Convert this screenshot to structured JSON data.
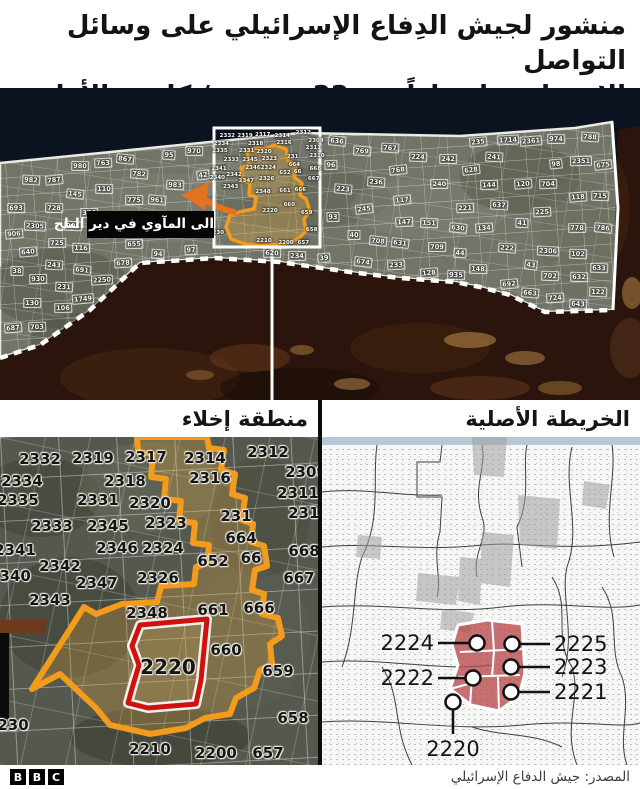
{
  "header": {
    "line1": "منشور لجيش الدِفاع الإسرائيلي على وسائل التواصل",
    "line2": "الاجتماعي اعتباراً من 22 ديسمبر/ كانون الأول"
  },
  "main_map": {
    "evacuation_label": "الى المآوي في دير البلح",
    "zone_numbers": [
      "93",
      "94",
      "95",
      "96",
      "97",
      "98",
      "110",
      "102",
      "106",
      "122",
      "118",
      "117",
      "116",
      "43",
      "44",
      "41",
      "42",
      "38",
      "39",
      "40",
      "36",
      "221",
      "222",
      "223",
      "224",
      "225",
      "231",
      "233",
      "234",
      "235",
      "236",
      "240",
      "241",
      "242",
      "243",
      "245",
      "140",
      "151",
      "134",
      "148",
      "128",
      "130",
      "120",
      "145",
      "144",
      "147",
      "2305",
      "2306",
      "2351",
      "2250",
      "2361",
      "676",
      "678",
      "787",
      "788",
      "786",
      "663",
      "708",
      "782",
      "983",
      "980",
      "769",
      "778",
      "728",
      "785",
      "709",
      "775",
      "725",
      "724",
      "741",
      "767",
      "763",
      "768",
      "982",
      "974",
      "970",
      "632",
      "687",
      "704",
      "703",
      "702",
      "693",
      "692",
      "674",
      "643",
      "633",
      "637",
      "675",
      "635",
      "640",
      "628",
      "630",
      "631",
      "603",
      "691",
      "715",
      "796",
      "963",
      "961",
      "910",
      "905",
      "902",
      "906",
      "900",
      "620",
      "608",
      "1101",
      "1743",
      "1745",
      "1744",
      "1746",
      "1747",
      "1750",
      "1749",
      "1785",
      "1756",
      "645",
      "634",
      "638",
      "672",
      "646",
      "636",
      "655",
      "934",
      "653",
      "722",
      "723",
      "733",
      "734",
      "753",
      "751",
      "755",
      "758",
      "756",
      "525",
      "527",
      "572",
      "573",
      "578",
      "576",
      "523",
      "378",
      "374",
      "376",
      "852",
      "864",
      "867",
      "745",
      "731",
      "817",
      "717",
      "811",
      "577",
      "528",
      "571",
      "575",
      "579",
      "581",
      "587",
      "590",
      "930",
      "927",
      "981",
      "935",
      "882",
      "861",
      "685",
      "341",
      "310",
      "1722",
      "1714",
      "854"
    ]
  },
  "left_panel": {
    "title": "منطقة إخلاء",
    "highlighted_zone": "2220",
    "labels": [
      {
        "n": "2332",
        "x": 40,
        "y": 22
      },
      {
        "n": "2319",
        "x": 93,
        "y": 21
      },
      {
        "n": "2317",
        "x": 146,
        "y": 20
      },
      {
        "n": "2314",
        "x": 205,
        "y": 21
      },
      {
        "n": "2312",
        "x": 268,
        "y": 15
      },
      {
        "n": "2334",
        "x": 22,
        "y": 44
      },
      {
        "n": "2318",
        "x": 125,
        "y": 44
      },
      {
        "n": "2316",
        "x": 210,
        "y": 41
      },
      {
        "n": "2309",
        "x": 306,
        "y": 35
      },
      {
        "n": "2335",
        "x": 18,
        "y": 63
      },
      {
        "n": "2331",
        "x": 98,
        "y": 63
      },
      {
        "n": "2320",
        "x": 150,
        "y": 66
      },
      {
        "n": "2311",
        "x": 298,
        "y": 56
      },
      {
        "n": "231",
        "x": 236,
        "y": 79
      },
      {
        "n": "2310",
        "x": 309,
        "y": 76
      },
      {
        "n": "2333",
        "x": 52,
        "y": 89
      },
      {
        "n": "2345",
        "x": 108,
        "y": 89
      },
      {
        "n": "2323",
        "x": 166,
        "y": 86
      },
      {
        "n": "664",
        "x": 241,
        "y": 101
      },
      {
        "n": "2341",
        "x": 15,
        "y": 113
      },
      {
        "n": "2346",
        "x": 117,
        "y": 111
      },
      {
        "n": "2324",
        "x": 163,
        "y": 111
      },
      {
        "n": "652",
        "x": 213,
        "y": 124
      },
      {
        "n": "66",
        "x": 251,
        "y": 121
      },
      {
        "n": "668",
        "x": 304,
        "y": 114
      },
      {
        "n": "2342",
        "x": 60,
        "y": 129
      },
      {
        "n": "2340",
        "x": 10,
        "y": 139
      },
      {
        "n": "2347",
        "x": 97,
        "y": 146
      },
      {
        "n": "2326",
        "x": 158,
        "y": 141
      },
      {
        "n": "667",
        "x": 299,
        "y": 141
      },
      {
        "n": "2343",
        "x": 50,
        "y": 163
      },
      {
        "n": "2348",
        "x": 147,
        "y": 176
      },
      {
        "n": "661",
        "x": 213,
        "y": 173
      },
      {
        "n": "666",
        "x": 259,
        "y": 171
      },
      {
        "n": "660",
        "x": 226,
        "y": 213
      },
      {
        "n": "2220",
        "x": 168,
        "y": 230,
        "big": true
      },
      {
        "n": "659",
        "x": 278,
        "y": 234
      },
      {
        "n": "230",
        "x": 13,
        "y": 288
      },
      {
        "n": "658",
        "x": 293,
        "y": 281
      },
      {
        "n": "2210",
        "x": 150,
        "y": 312
      },
      {
        "n": "2200",
        "x": 216,
        "y": 316
      },
      {
        "n": "657",
        "x": 268,
        "y": 316
      }
    ]
  },
  "right_panel": {
    "title": "الخريطة الأصلية",
    "callouts": [
      {
        "label": "2224",
        "cx": 155,
        "cy": 206,
        "tx": 112,
        "ty": 206,
        "align": "right"
      },
      {
        "label": "2225",
        "cx": 190,
        "cy": 207,
        "tx": 232,
        "ty": 207,
        "align": "left"
      },
      {
        "label": "2223",
        "cx": 189,
        "cy": 230,
        "tx": 232,
        "ty": 230,
        "align": "left"
      },
      {
        "label": "2222",
        "cx": 151,
        "cy": 241,
        "tx": 112,
        "ty": 241,
        "align": "right"
      },
      {
        "label": "2221",
        "cx": 189,
        "cy": 255,
        "tx": 232,
        "ty": 255,
        "align": "left"
      },
      {
        "label": "2220",
        "cx": 131,
        "cy": 265,
        "tx": 131,
        "ty": 300,
        "align": "center"
      }
    ]
  },
  "footer": {
    "bbc": [
      "B",
      "B",
      "C"
    ],
    "source": "المصدر: جيش الدفاع الإسرائيلي"
  },
  "colors": {
    "orange": "#f29b1d",
    "arrow_orange": "#e2731f",
    "red": "#cf1110",
    "sea": "#0a131f",
    "coast_blue": "#b7c7d7"
  }
}
